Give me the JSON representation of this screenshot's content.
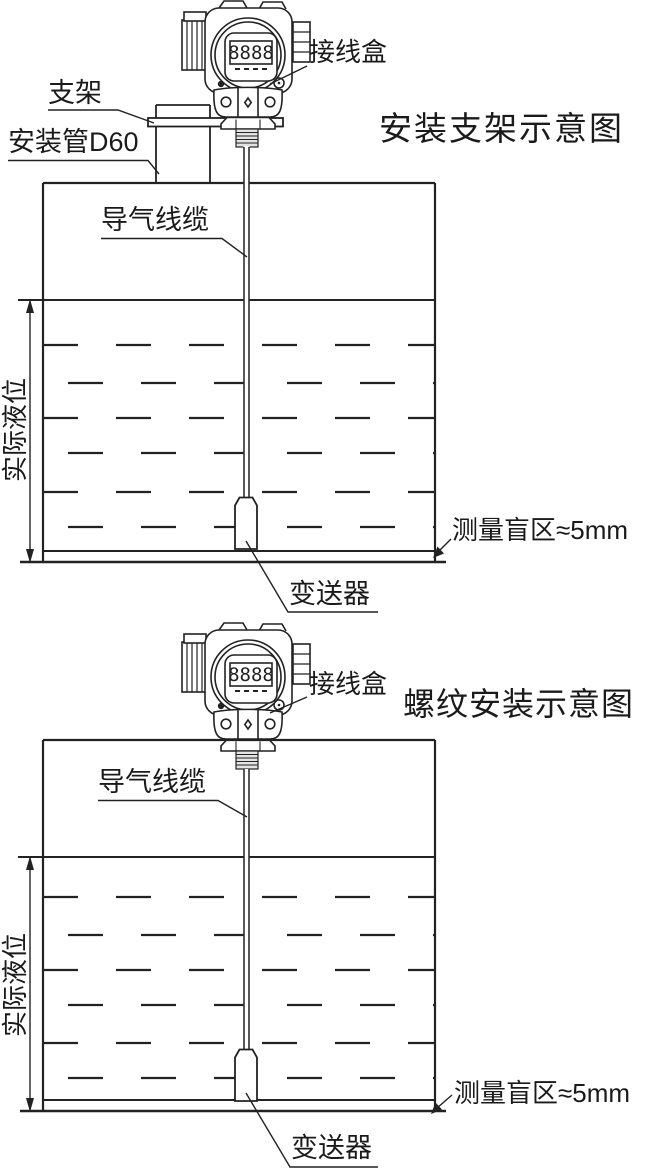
{
  "colors": {
    "background": "#ffffff",
    "line": "#222222",
    "thread_fill": "#e3e3e3"
  },
  "top_diagram": {
    "title": "安装支架示意图",
    "bracket_label": "支架",
    "mounting_pipe_label": "安装管D60",
    "junction_box_label": "接线盒",
    "air_cable_label": "导气线缆",
    "actual_level_label": "实际液位",
    "blind_zone_label": "测量盲区≈5mm",
    "transmitter_label": "变送器",
    "lcd_value": "8888"
  },
  "bottom_diagram": {
    "title": "螺纹安装示意图",
    "junction_box_label": "接线盒",
    "air_cable_label": "导气线缆",
    "actual_level_label": "实际液位",
    "blind_zone_label": "测量盲区≈5mm",
    "transmitter_label": "变送器",
    "lcd_value": "8888"
  }
}
